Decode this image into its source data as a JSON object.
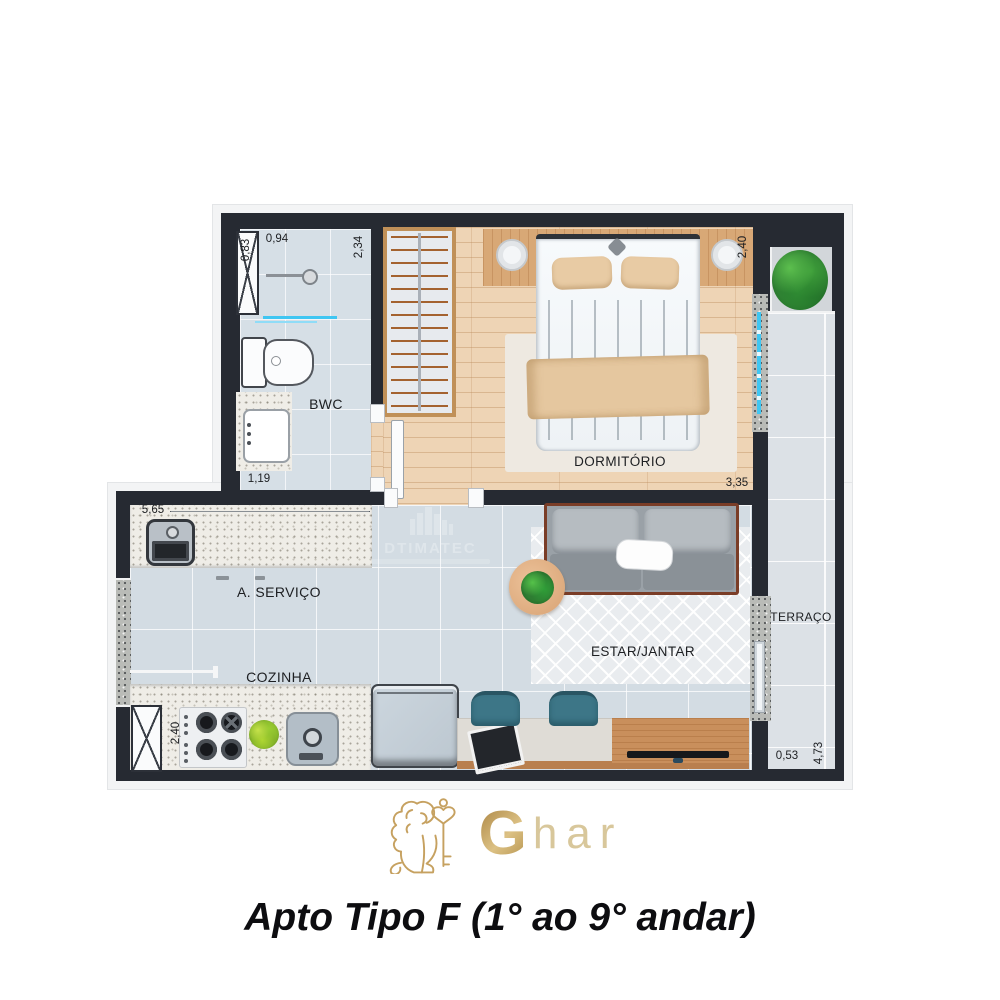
{
  "title": "Apto Tipo F (1° ao 9° andar)",
  "watermark": {
    "text": "DTIMATEC"
  },
  "logo": {
    "g": "G",
    "rest": "har"
  },
  "labels": {
    "bwc": "BWC",
    "dormitorio": "DORMITÓRIO",
    "servico": "A. SERVIÇO",
    "cozinha": "COZINHA",
    "estar": "ESTAR/JANTAR",
    "terraco": "TERRAÇO"
  },
  "dims": {
    "bwc_w": "0,83",
    "shower_w": "0,94",
    "bwc_h": "2,34",
    "vanity": "1,19",
    "dorm_w": "2,40",
    "dorm_l": "3,35",
    "servico_l": "5,65",
    "cozinha_w": "2,40",
    "terraco_w": "0,53",
    "terraco_l": "4,73"
  },
  "colors": {
    "wall": "#262a32",
    "glass": "#3fc6f2",
    "gold": "#c0a05e",
    "wood": "#eed4b5",
    "sofa": "#9aa1a7",
    "chair_teal": "#3d7687"
  }
}
